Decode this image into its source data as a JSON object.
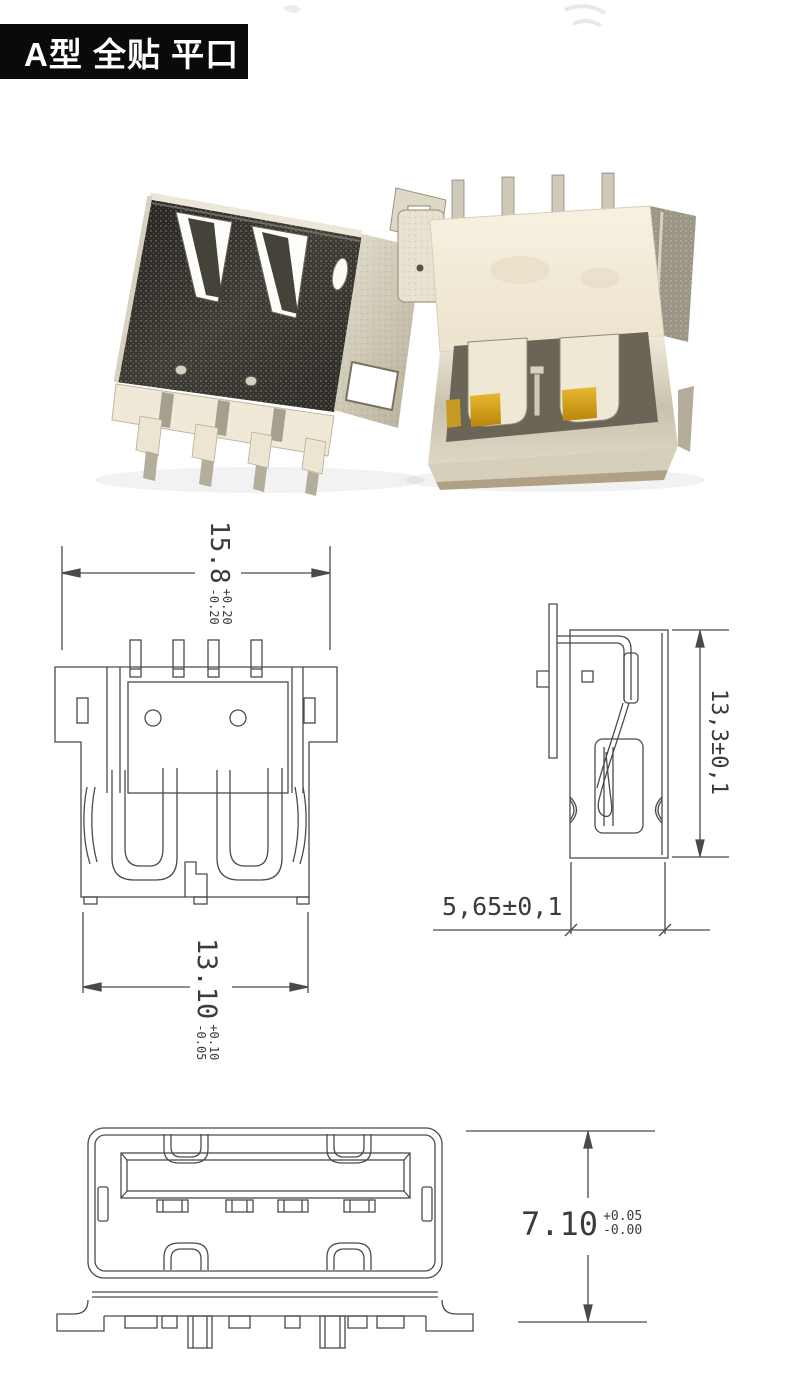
{
  "header": {
    "title": "A型 全贴 平口"
  },
  "colors": {
    "title_bg": "#0a0a0a",
    "title_text": "#ffffff",
    "line": "#4a4a49",
    "background": "#ffffff",
    "gold_contact": "#c8961e",
    "plastic": "#f2ebd9",
    "shell_dark": "#35332d"
  },
  "photo": {
    "left_connector": "usb-a-receptacle-top-shell",
    "right_connector": "usb-a-receptacle-flipped"
  },
  "drawings": {
    "top_view": {
      "dim_width": {
        "value": "15.8",
        "tol_plus": "+0.20",
        "tol_minus": "-0.20"
      },
      "dim_inner_width": {
        "value": "13.10",
        "tol_plus": "+0.10",
        "tol_minus": "-0.05"
      }
    },
    "side_view": {
      "dim_height": {
        "value": "13,3±0,1"
      },
      "dim_depth": {
        "value": "5,65±0,1"
      }
    },
    "front_view": {
      "dim_height": {
        "value": "7.10",
        "tol_plus": "+0.05",
        "tol_minus": "-0.00"
      }
    }
  }
}
